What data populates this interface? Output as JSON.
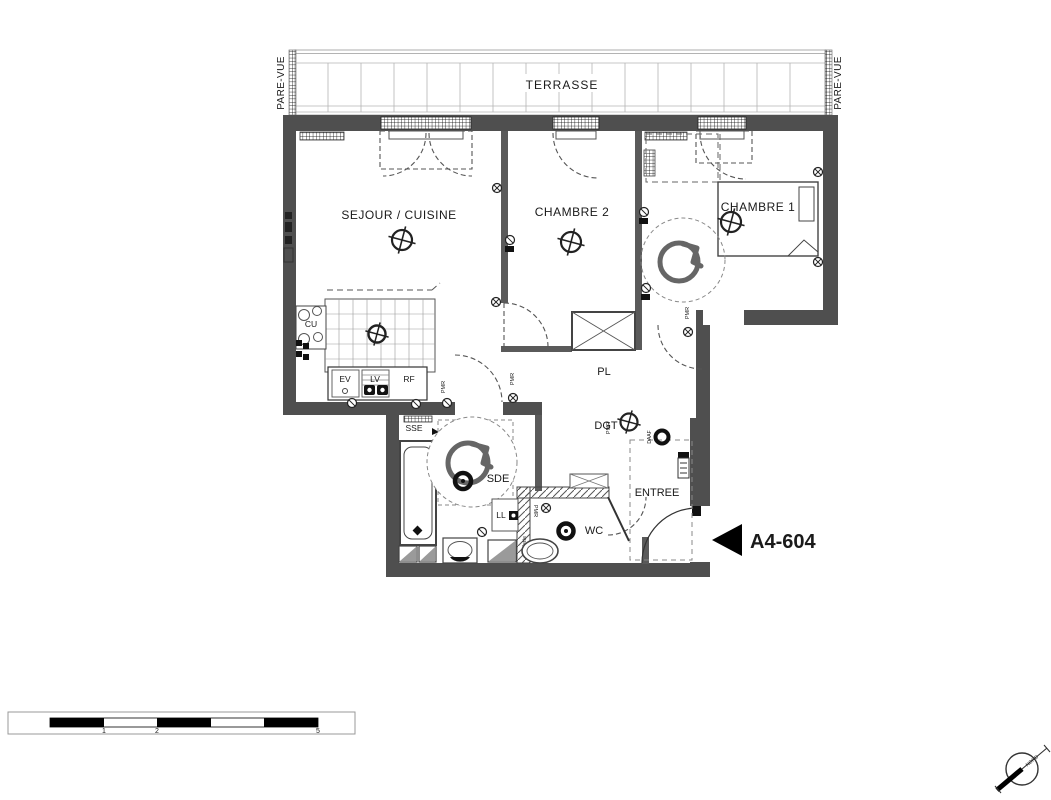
{
  "plan": {
    "unit": {
      "label": "A4-604"
    },
    "terrace": {
      "label": "TERRASSE",
      "screen_left": "PARE-VUE",
      "screen_right": "PARE-VUE"
    },
    "rooms": {
      "living_kitchen": "SEJOUR / CUISINE",
      "bedroom2": "CHAMBRE 2",
      "bedroom1": "CHAMBRE 1",
      "shower_room": "SDE",
      "wc": "WC",
      "entry": "ENTREE",
      "hallway": "DGT",
      "closet": "PL"
    },
    "fixtures": {
      "hob": "CU",
      "sink": "EV",
      "dishwasher": "LV",
      "fridge": "RF",
      "washer": "LL",
      "towel_dryer": "SSE",
      "shelf": "tablette",
      "smoke_detector": "DAAF",
      "pmr": "PMR"
    },
    "scale_bar": {
      "tick1": "1",
      "tick2": "2",
      "tick3": "5"
    },
    "compass": {
      "north": "NORD"
    }
  }
}
